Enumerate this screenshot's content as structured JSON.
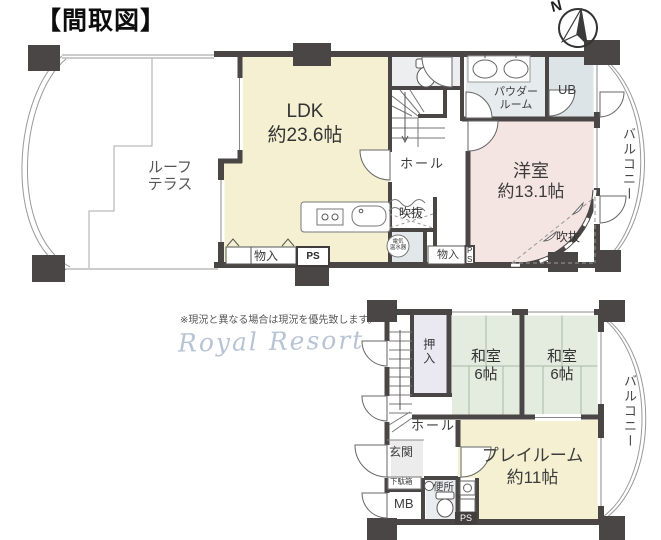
{
  "title": "【間取図】",
  "compass": {
    "north": "N"
  },
  "upper_plan": {
    "roof_terrace_line1": "ルーフ",
    "roof_terrace_line2": "テラス",
    "ldk_name": "LDK",
    "ldk_area": "約23.6帖",
    "hall": "ホール",
    "powder_line1": "パウダー",
    "powder_line2": "ルーム",
    "ub": "UB",
    "western_room_name": "洋室",
    "western_room_area": "約13.1帖",
    "void_left": "吹抜",
    "void_right": "吹抜",
    "storage_left": "物入",
    "ps_left": "PS",
    "storage_right": "物入",
    "ps_right": "PS",
    "water_heater_line1": "電気",
    "water_heater_line2": "温水器",
    "balcony": "バルコニー"
  },
  "lower_plan": {
    "closet": "押入",
    "japanese_room1_name": "和室",
    "japanese_room1_area": "6帖",
    "japanese_room2_name": "和室",
    "japanese_room2_area": "6帖",
    "hall": "ホール",
    "entrance": "玄関",
    "shoe_box": "下駄箱",
    "meter_box": "MB",
    "toilet": "便所",
    "ps": "PS",
    "playroom_name": "プレイルーム",
    "playroom_area": "約11帖",
    "balcony": "バルコニー"
  },
  "notes": {
    "disclaimer": "※現況と異なる場合は現況を優先致します。",
    "logo": "Royal Resort"
  },
  "colors": {
    "wall": "#4a4645",
    "ldk": "#f4f0d1",
    "western_room": "#f5e5e2",
    "japanese_room": "#e3ecdf",
    "closet": "#eae9f2",
    "wet_area": "#e6ebee",
    "playroom": "#f4f0d1",
    "logo": "#b8c3d5"
  }
}
